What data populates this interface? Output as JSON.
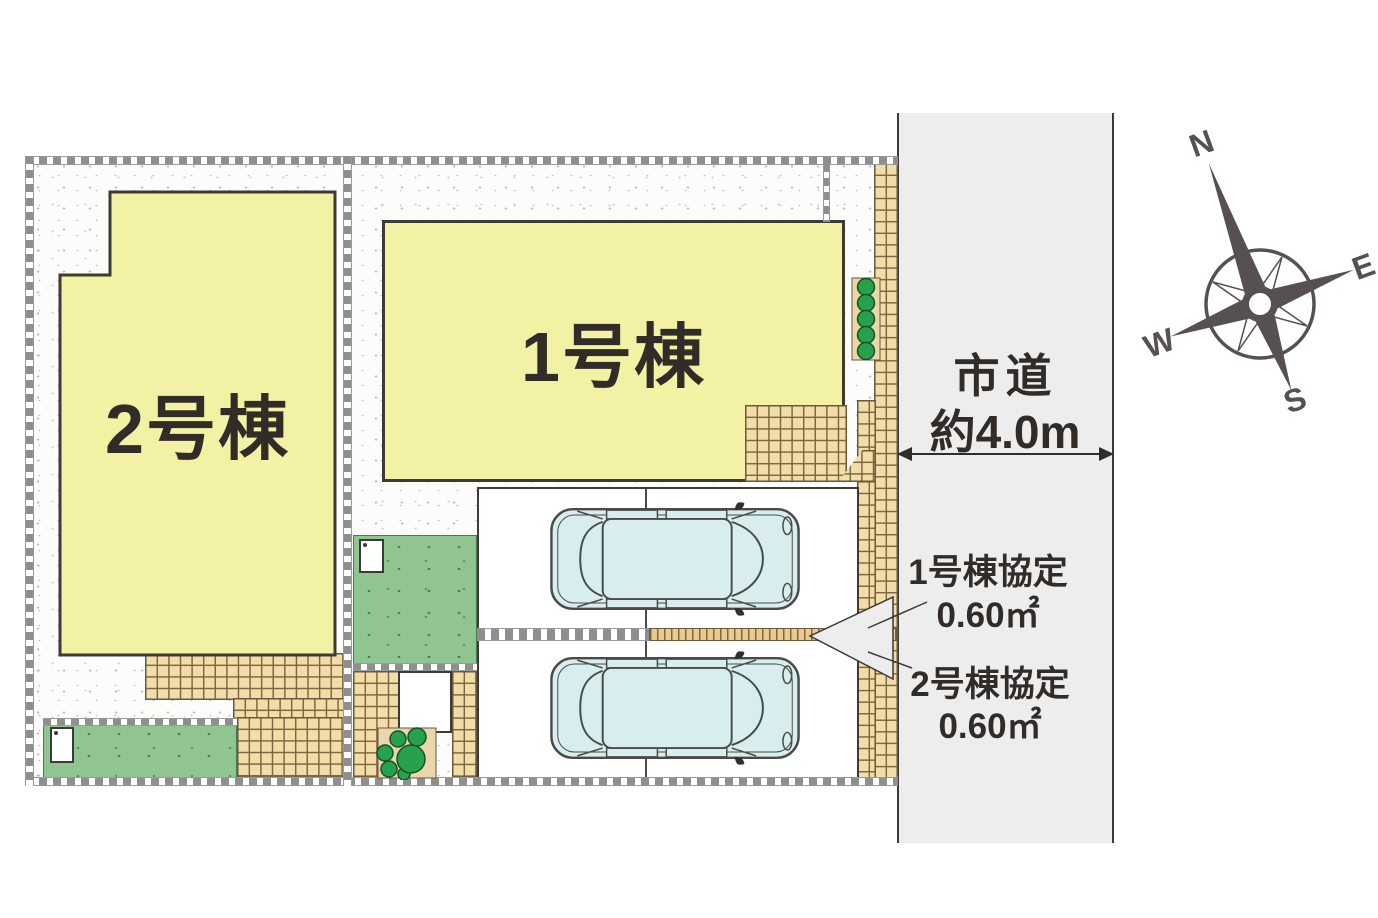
{
  "plan": {
    "building1": {
      "label": "1号棟"
    },
    "building2": {
      "label": "2号棟"
    },
    "road": {
      "name": "市道",
      "width": "約4.0m"
    },
    "agreement1": {
      "title": "1号棟協定",
      "area": "0.60㎡"
    },
    "agreement2": {
      "title": "2号棟協定",
      "area": "0.60㎡"
    },
    "compass": {
      "north": "N",
      "east": "E",
      "west": "W",
      "south": "S"
    },
    "colors": {
      "building": "#f3f1a3",
      "grass": "#90c592",
      "tile": "#f2dca8",
      "road": "#ededed",
      "car": "#d7edee",
      "tree": "#27a14b",
      "outline": "#3a3531"
    }
  }
}
